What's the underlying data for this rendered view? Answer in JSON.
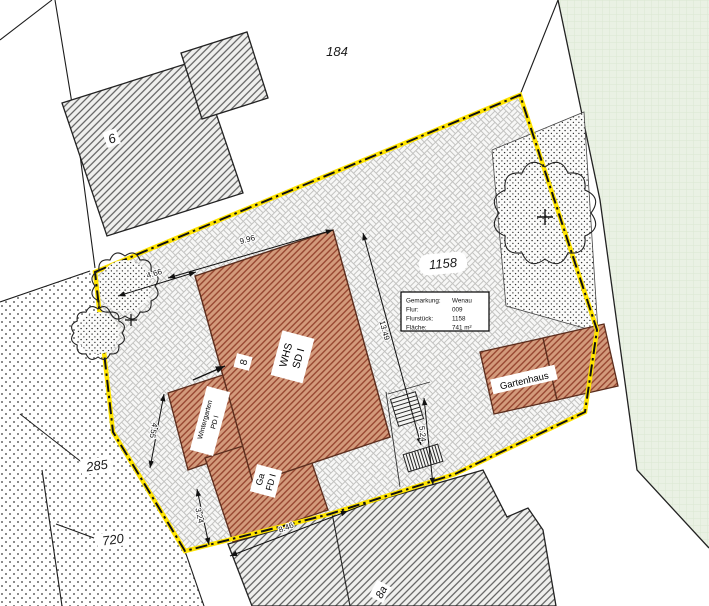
{
  "parcel_numbers": {
    "north_parcel": "184",
    "main_parcel": "1158",
    "southwest_parcel_1": "285",
    "southwest_parcel_2": "720"
  },
  "house_numbers": {
    "neighbor_northwest": "6",
    "main_house": "8",
    "neighbor_south": "8a"
  },
  "info_box": {
    "rows": [
      {
        "label": "Gemarkung:",
        "value": "Wenau"
      },
      {
        "label": "Flur:",
        "value": "009"
      },
      {
        "label": "Flurstück:",
        "value": "1158"
      },
      {
        "label": "Fläche:",
        "value": "741 m²"
      }
    ]
  },
  "buildings": {
    "main_house": {
      "line1": "WHS",
      "line2": "SD I"
    },
    "wintergarten": {
      "line1": "Wintergarten",
      "line2": "PD I"
    },
    "garage": {
      "line1": "Ga",
      "line2": "FD I"
    },
    "garden_house": {
      "label": "Gartenhaus"
    }
  },
  "dimensions_m": {
    "north_wall": "9.96",
    "northwest_gap": "4.66",
    "east_wall": "13.49",
    "east_path": "5.24",
    "west_wintergarten": "4.55",
    "garage_west": "3.24",
    "south_neighbor": "8.46"
  },
  "colors": {
    "boundary_yellow": "#ffe400",
    "new_building_fill": "#d39a7b",
    "new_building_hatch": "#93412b",
    "existing_building_fill": "#efefed",
    "existing_building_hatch": "#4f4f4f",
    "green_area_fill": "#eaf1e4",
    "paver_joint": "#c3c3c1"
  }
}
